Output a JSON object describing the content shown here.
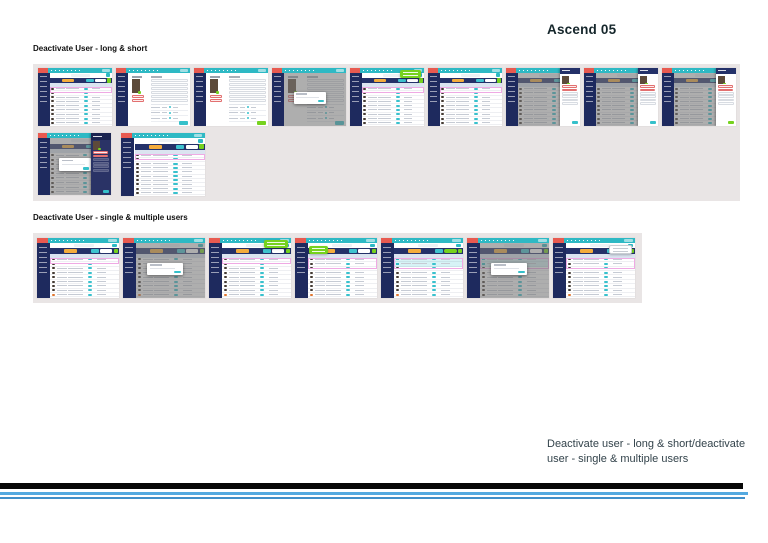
{
  "page": {
    "title": "Ascend 05"
  },
  "caption": "Deactivate user - long & short/deactivate user - single & multiple users",
  "colors": {
    "teal": "#2eb9c4",
    "red": "#e85a50",
    "navy": "#1e2a5e",
    "navy2": "#243169",
    "yellow": "#f4ac3c",
    "green": "#76d21e",
    "pink": "#efaae4",
    "band": "#e9e5e5",
    "blue1": "#54a9e0",
    "blue2": "#418fc9"
  },
  "sections": [
    {
      "heading": "Deactivate User - long & short",
      "rows": [
        [
          {
            "name": "thumb-user-list",
            "kind": "list",
            "pink_rows": 1,
            "rows": 9
          },
          {
            "name": "thumb-user-detail",
            "kind": "detail",
            "action": "teal"
          },
          {
            "name": "thumb-user-detail",
            "kind": "detail",
            "action": "green"
          },
          {
            "name": "thumb-user-detail-confirm-modal",
            "kind": "detail",
            "overlay": true,
            "modal": true,
            "action": "teal"
          },
          {
            "name": "thumb-user-list-success-toast",
            "kind": "list",
            "pink_rows": 1,
            "rows": 9,
            "tooltip": "green-right"
          },
          {
            "name": "thumb-user-list",
            "kind": "list",
            "pink_rows": 1,
            "rows": 9
          },
          {
            "name": "thumb-user-list-detail-drawer",
            "kind": "list",
            "overlay": true,
            "drawer": "light",
            "action": "teal",
            "rows": 9
          },
          {
            "name": "thumb-user-list-detail-drawer",
            "kind": "list",
            "overlay": true,
            "drawer": "light",
            "action": "teal",
            "rows": 9
          },
          {
            "name": "thumb-user-list-detail-drawer",
            "kind": "list",
            "overlay": true,
            "drawer": "light",
            "action": "green",
            "rows": 9
          }
        ],
        [
          {
            "name": "thumb-user-list-drawer-confirm-modal",
            "kind": "list",
            "overlay": true,
            "modal": true,
            "drawer": "dark",
            "action": "teal",
            "rows": 9
          },
          {
            "name": "thumb-user-list",
            "kind": "list",
            "pink_rows": 1,
            "rows": 10
          }
        ]
      ]
    },
    {
      "heading": "Deactivate User - single & multiple users",
      "rows": [
        [
          {
            "name": "thumb-user-list",
            "kind": "list",
            "pink_rows": 1,
            "rows": 9,
            "orange_last": true
          },
          {
            "name": "thumb-user-list-confirm-modal",
            "kind": "list",
            "overlay": true,
            "modal": true,
            "rows": 9,
            "orange_last": true
          },
          {
            "name": "thumb-user-list-success-toast",
            "kind": "list",
            "pink_rows": 1,
            "rows": 9,
            "tooltip": "green-right",
            "orange_last": true
          },
          {
            "name": "thumb-user-list-bulk-tooltip",
            "kind": "list",
            "pink_rows": 2,
            "rows": 9,
            "tooltip": "green-left",
            "orange_last": true
          },
          {
            "name": "thumb-user-list-selected",
            "kind": "list",
            "selected_rows": 2,
            "rows": 9,
            "green_toolbar": true,
            "orange_last": true
          },
          {
            "name": "thumb-user-list-selected-confirm-modal",
            "kind": "list",
            "selected_rows": 2,
            "overlay": true,
            "modal": true,
            "rows": 9
          },
          {
            "name": "thumb-user-list-dropdown",
            "kind": "list",
            "pink_rows": 2,
            "rows": 9,
            "tooltip": "white-right",
            "orange_last": true
          }
        ]
      ]
    }
  ]
}
